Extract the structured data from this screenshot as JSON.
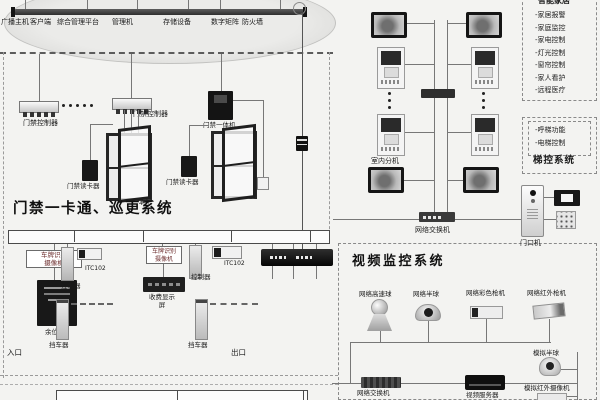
{
  "top_bus": {
    "labels": [
      "广播主机",
      "客户端",
      "综合管理平台",
      "管理机",
      "存储设备",
      "数字矩阵",
      "防火墙"
    ]
  },
  "smart_home": {
    "title": "智能家居",
    "items": [
      "家居报警",
      "家庭监控",
      "家电控制",
      "灯光控制",
      "窗帘控制",
      "家人看护",
      "远程医疗"
    ]
  },
  "elevator": {
    "title": "梯控系统",
    "items": [
      "呼梯功能",
      "电梯控制"
    ]
  },
  "intercom": {
    "indoor_label": "室内分机",
    "switch_label": "网络交换机",
    "door_station_label": "门口机"
  },
  "access": {
    "title": "门禁一卡通、巡更系统",
    "controller_label": "门禁控制器",
    "allinone_label": "门禁一体机",
    "reader_label": "门禁读卡器",
    "door_count": "4门"
  },
  "parking": {
    "entry": {
      "box1": "车牌识别",
      "box2": "摄像机",
      "display": "余位屏",
      "controller": "控制器",
      "model": "ITC102",
      "barrier": "挡车器",
      "gate": "入口"
    },
    "exit": {
      "box1": "车牌识别",
      "box2": "摄像机",
      "display": "收费显示屏",
      "controller": "控制器",
      "model": "ITC102",
      "barrier": "挡车器",
      "gate": "出口"
    }
  },
  "video": {
    "title": "视频监控系统",
    "cameras": [
      "网络高速球",
      "网络半球",
      "网络彩色枪机",
      "网络红外枪机"
    ],
    "switch_label": "网络交换机",
    "server_label": "视频服务器",
    "analog_dome": "模拟半球",
    "analog_ir": "模拟红外摄像机"
  }
}
